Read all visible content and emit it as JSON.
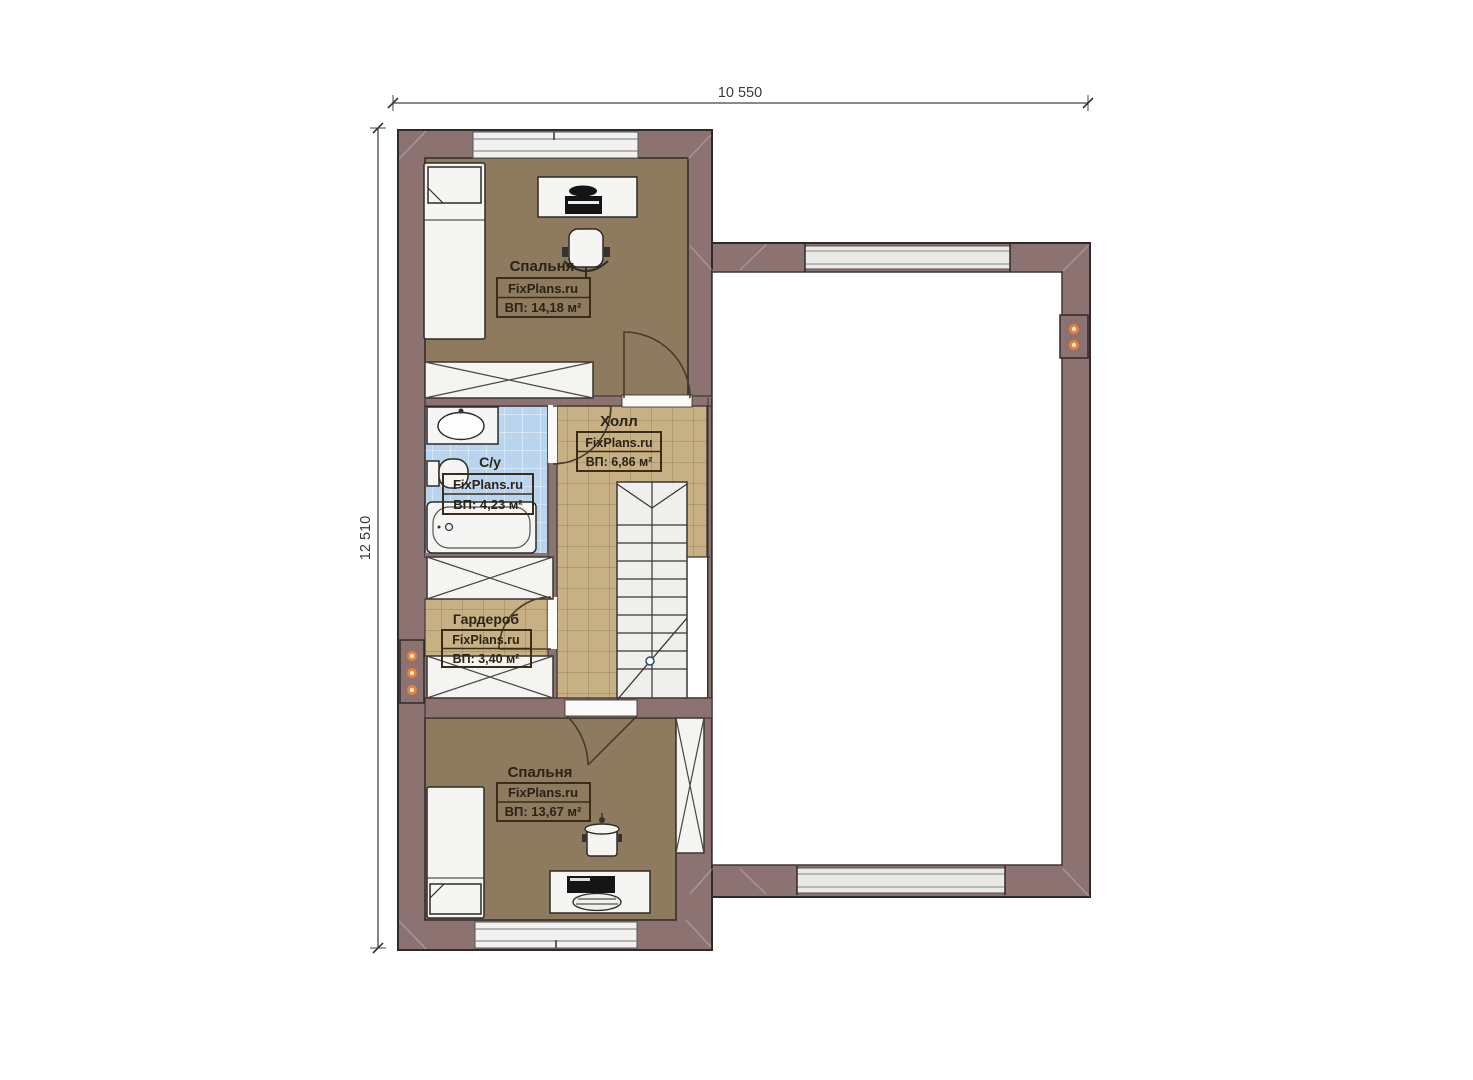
{
  "plan": {
    "watermark": "FixPlans.ru",
    "dimensions": {
      "width_label": "10 550",
      "height_label": "12 510"
    },
    "rooms": {
      "bedroom_top": {
        "name": "Спальня",
        "area": "ВП: 14,18 м²"
      },
      "bathroom": {
        "name": "С/у",
        "area": "ВП: 4,23 м²"
      },
      "hall": {
        "name": "Холл",
        "area": "ВП: 6,86 м²"
      },
      "wardrobe": {
        "name": "Гардероб",
        "area": "ВП: 3,40 м²"
      },
      "bedroom_bottom": {
        "name": "Спальня",
        "area": "ВП: 13,67 м²"
      }
    },
    "colors": {
      "wall": "#8c7372",
      "bedroom_floor": "#8e7b5f",
      "hall_floor": "#c6b084",
      "bath_floor": "#b9d4ee",
      "vent_dot": "#e8833a",
      "label_ink": "#2b2315"
    }
  }
}
